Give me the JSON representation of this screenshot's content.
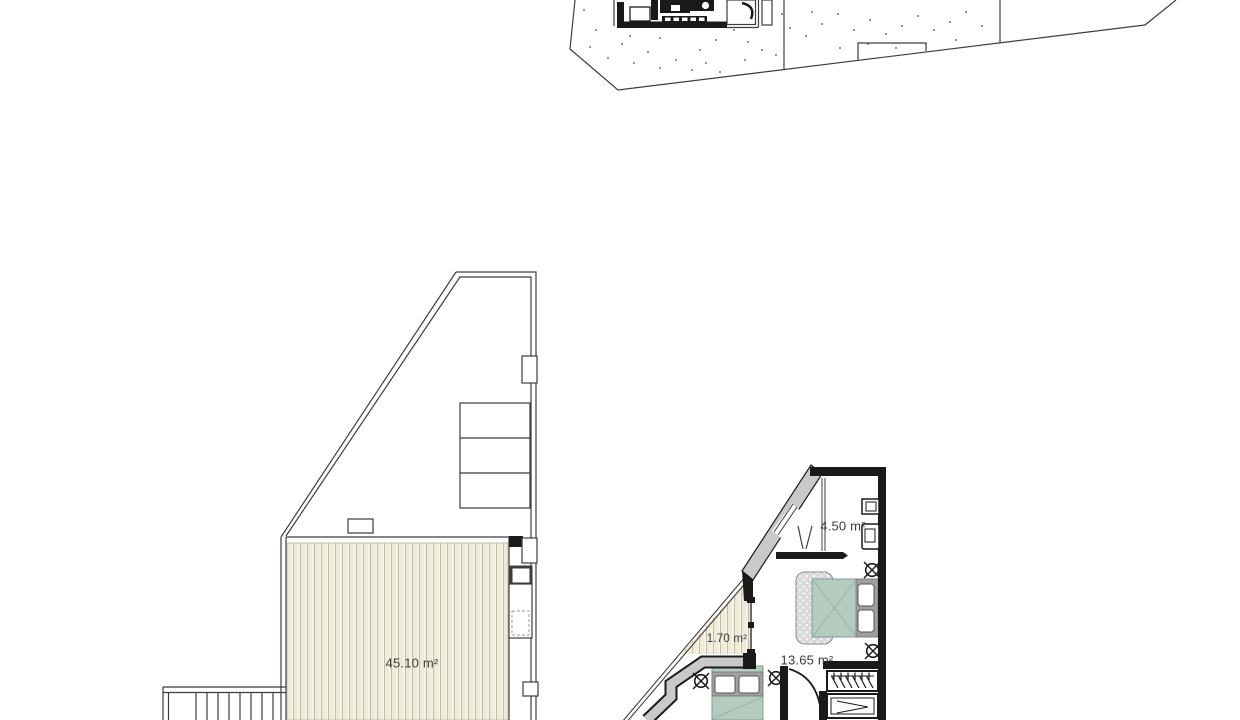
{
  "labels": {
    "roof_terrace_area": "45.10 m²",
    "bathroom_area": "4.50 m²",
    "balcony_area": "1.70 m²",
    "bedroom_area": "13.65 m²"
  },
  "colors": {
    "background": "#ffffff",
    "line": "#3d3d3d",
    "wall_black": "#1a1a1a",
    "wall_poche": "#c9c9c9",
    "terrace_hatch_base": "#f4f2e4",
    "terrace_hatch_stripe": "#eeebd8",
    "bed_fill": "#b5cbc0",
    "headboard_fill": "#9f9f9f",
    "rug_fill": "#d9d9d9",
    "label_text": "#3a3a3a"
  }
}
